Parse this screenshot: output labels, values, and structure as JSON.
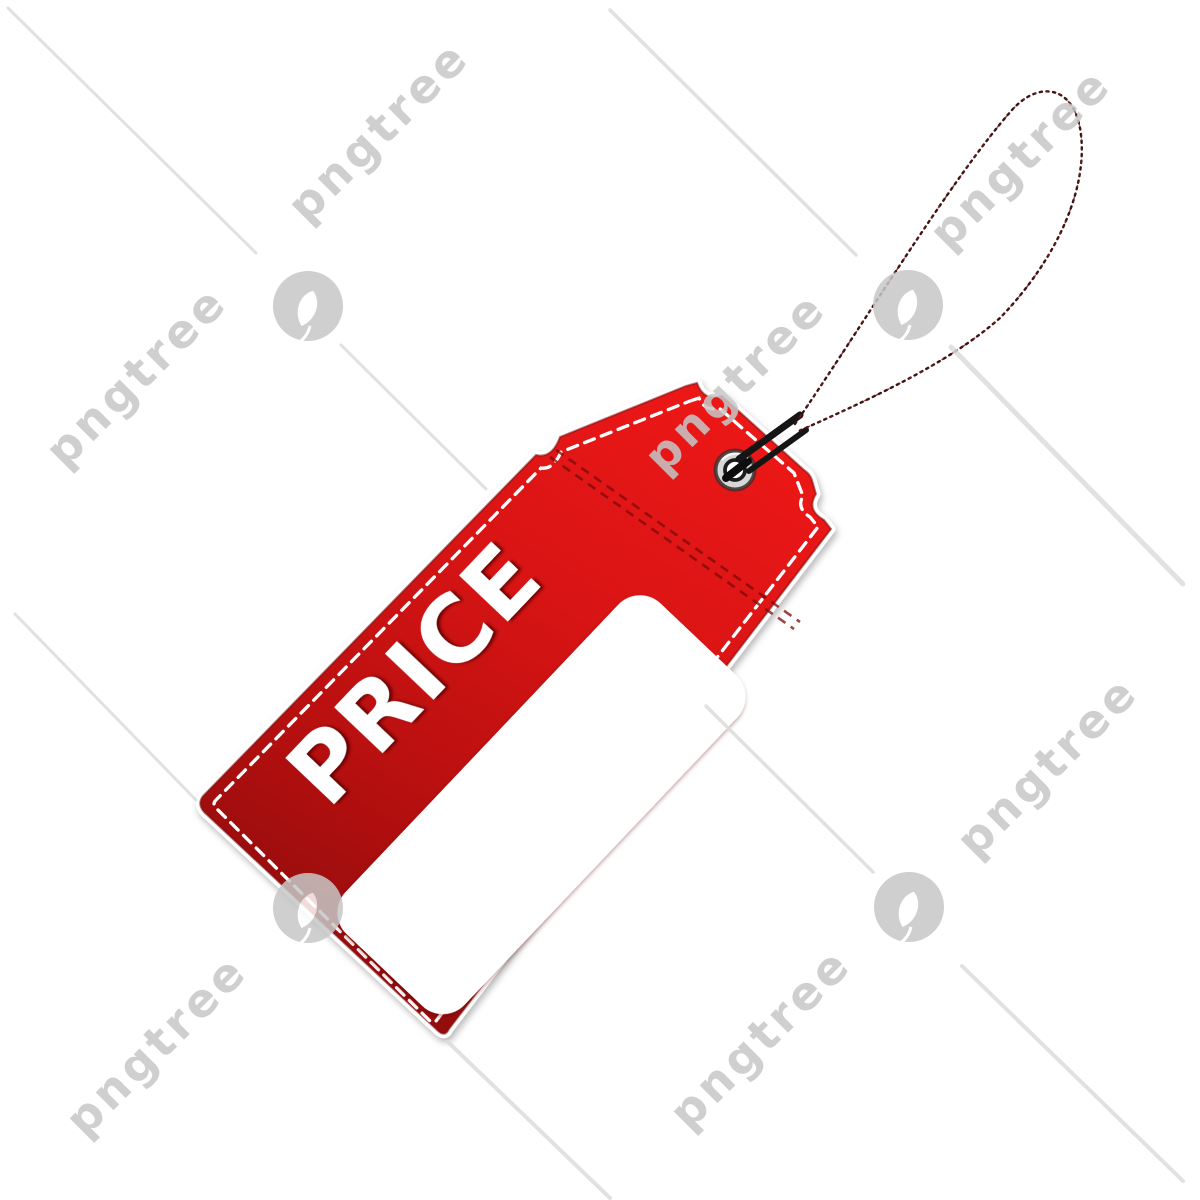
{
  "image": {
    "description_label": "red price tag clipart with string and blank white label",
    "background_color": "#ffffff"
  },
  "tag": {
    "label": "PRICE",
    "label_area_text": "",
    "colors": {
      "red_top": "#ec1717",
      "red_mid": "#cf1212",
      "red_bottom": "#8e0c0c",
      "stitch_white": "#ffffff",
      "seam_dark_red": "#7e0909",
      "edge_dark_red": "#7a0a0a",
      "price_shadow": "#5f0505",
      "string_black": "#1a0d0d",
      "eyelet_silver": "#d8d8d8"
    }
  },
  "watermark": {
    "brand": "pngtree",
    "color": "#c7c7c7",
    "line_color": "#dcdcdc",
    "opacity": 0.85,
    "texts": [
      {
        "x": 378,
        "y": 131
      },
      {
        "x": 1020,
        "y": 158
      },
      {
        "x": 136,
        "y": 376
      },
      {
        "x": 735,
        "y": 382
      },
      {
        "x": 156,
        "y": 1045
      },
      {
        "x": 760,
        "y": 1038
      },
      {
        "x": 1047,
        "y": 766
      }
    ],
    "logos": [
      {
        "x": 308,
        "y": 306
      },
      {
        "x": 908,
        "y": 305
      },
      {
        "x": 308,
        "y": 908
      },
      {
        "x": 909,
        "y": 907
      }
    ],
    "lines": [
      {
        "x1": 8,
        "y1": 8,
        "x2": 256,
        "y2": 253,
        "w": 3
      },
      {
        "x1": 341,
        "y1": 345,
        "x2": 486,
        "y2": 489,
        "w": 3
      },
      {
        "x1": 610,
        "y1": 10,
        "x2": 856,
        "y2": 255,
        "w": 3.5
      },
      {
        "x1": 951,
        "y1": 347,
        "x2": 1183,
        "y2": 584,
        "w": 5
      },
      {
        "x1": 15,
        "y1": 614,
        "x2": 196,
        "y2": 800,
        "w": 3
      },
      {
        "x1": 448,
        "y1": 1042,
        "x2": 610,
        "y2": 1198,
        "w": 4
      },
      {
        "x1": 706,
        "y1": 706,
        "x2": 873,
        "y2": 872,
        "w": 3.5
      },
      {
        "x1": 962,
        "y1": 966,
        "x2": 1183,
        "y2": 1181,
        "w": 4
      }
    ]
  }
}
